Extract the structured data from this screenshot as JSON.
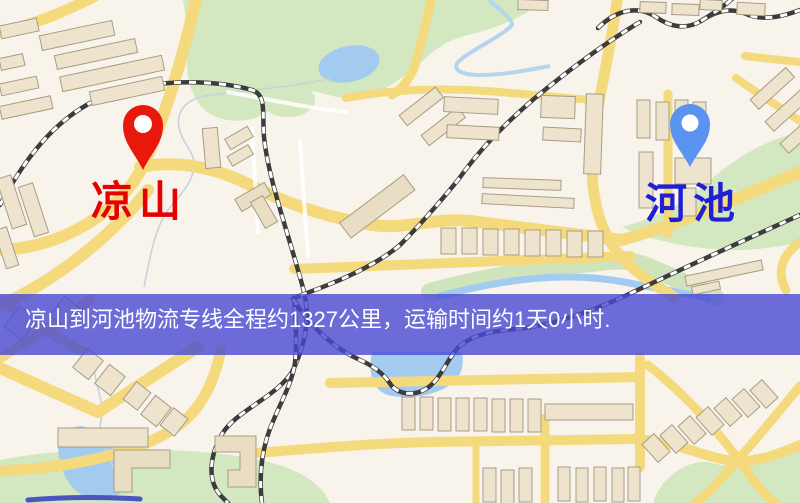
{
  "map": {
    "markers": [
      {
        "id": "origin",
        "label": "凉山",
        "pin_color": "#e8180c",
        "label_color": "#e60000"
      },
      {
        "id": "destination",
        "label": "河池",
        "pin_color": "#5b94f0",
        "label_color": "#1f1fd6"
      }
    ],
    "colors": {
      "background": "#f8f4ec",
      "road": "#f4da7c",
      "green_area": "#d3e7c0",
      "water": "#a3cbf0",
      "building": "#eee3cc",
      "building_outline": "#a79d84",
      "railway": "#3c3c3c"
    }
  },
  "banner": {
    "text": "凉山到河池物流专线全程约1327公里，运输时间约1天0小时.",
    "background": "#4849d3",
    "opacity": "0.80",
    "text_color": "#ffffff"
  }
}
